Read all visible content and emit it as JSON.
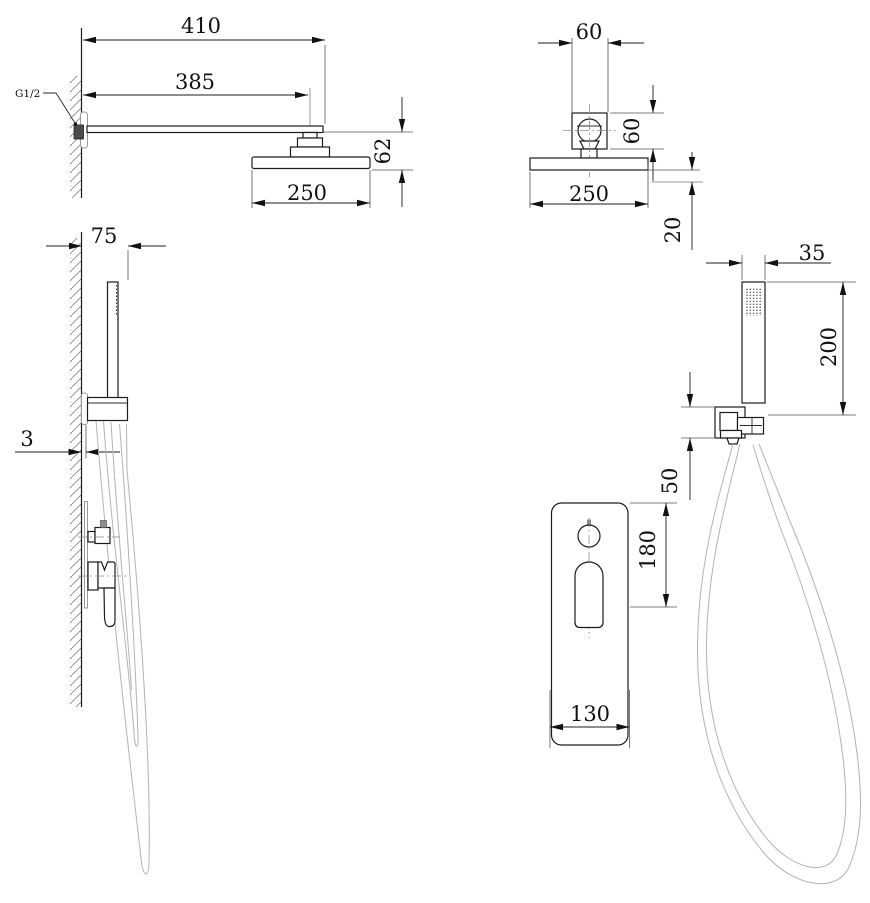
{
  "drawing": {
    "type": "shower-set-technical-drawing",
    "dims": {
      "rain_arm_overall": "410",
      "rain_arm_center": "385",
      "rain_drop": "62",
      "rain_head_side": "250",
      "thread_label": "G1/2",
      "bracket_width": "60",
      "bracket_height": "60",
      "rain_head_front": "250",
      "head_thickness": "20",
      "hand_offset": "75",
      "plate_gap": "3",
      "hand_width": "35",
      "hand_length": "200",
      "holder_height": "50",
      "mixer_height": "180",
      "mixer_width": "130"
    },
    "colors": {
      "line": "#1c1c1c",
      "aux": "#9a9a9a",
      "background": "#ffffff"
    }
  }
}
